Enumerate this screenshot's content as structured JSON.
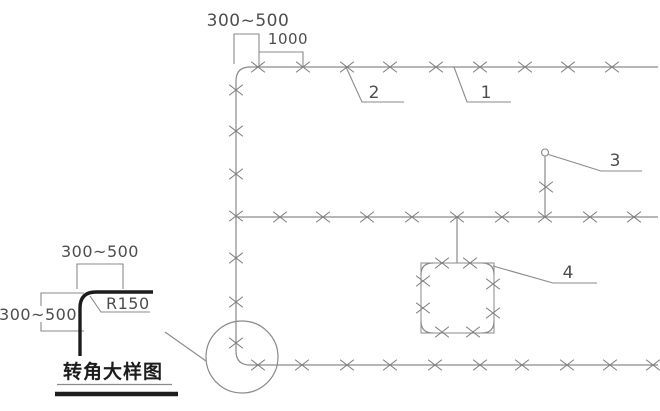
{
  "figure": {
    "width": 660,
    "height": 411,
    "colors": {
      "line": "#8a8a8a",
      "mark": "#7d7d7d",
      "text": "#4d4d4d",
      "ink": "#1c1c1c",
      "bg": "#ffffff"
    },
    "labels": {
      "dim_top_range": "300~500",
      "dim_top_spacing": "1000",
      "callout_1": "1",
      "callout_2": "2",
      "callout_3": "3",
      "callout_4": "4",
      "detail_dim_horizontal": "300~500",
      "detail_dim_vertical": "300~500",
      "detail_radius": "R150",
      "detail_title": "转角大样图"
    },
    "geometry": {
      "paths": [
        {
          "name": "main-cable-run",
          "d": "M 658,67 L 250,67 Q 236,67 236,81 L 236,351 Q 236,365 250,365 L 658,365",
          "color": "line",
          "w": 1.2
        },
        {
          "name": "middle-cable-run",
          "d": "M 236,217 L 658,217",
          "color": "line",
          "w": 1.2
        },
        {
          "name": "device-drop-line",
          "d": "M 457,217 L 457,263",
          "color": "line",
          "w": 1.2
        },
        {
          "name": "device-box-outline",
          "d": "M 421,263 L 494,263 L 494,333 L 421,333 Z",
          "color": "line",
          "w": 1.0
        },
        {
          "name": "device-box-corner-arcs",
          "d": "M 421,275 Q 421,263 433,263 M 482,263 Q 494,263 494,275 M 494,321 Q 494,333 482,333 M 433,333 Q 421,333 421,321",
          "color": "line",
          "w": 1.2
        },
        {
          "name": "branch-riser-stub",
          "d": "M 545,217 L 545,156.5",
          "color": "line",
          "w": 1.2
        },
        {
          "name": "leader-callout-1",
          "d": "M 454,67 L 467,102 L 511,102",
          "color": "line",
          "w": 1.1
        },
        {
          "name": "leader-callout-2",
          "d": "M 346,67 L 362,102 L 404,102",
          "color": "line",
          "w": 1.1
        },
        {
          "name": "leader-callout-3",
          "d": "M 548.5,154.5 L 601,171 L 642,171",
          "color": "line",
          "w": 1.1
        },
        {
          "name": "leader-callout-4",
          "d": "M 493,266 L 553,283 L 597,283",
          "color": "line",
          "w": 1.1
        },
        {
          "name": "dim-bracket-offset",
          "d": "M 234,64 L 234,34 L 259,34 L 259,66",
          "color": "line",
          "w": 1.1
        },
        {
          "name": "dim-bracket-spacing",
          "d": "M 259,52 L 303,52 L 303,66",
          "color": "line",
          "w": 1.1
        },
        {
          "name": "detail-dim-top-bracket",
          "d": "M 77,289 L 77,264 L 123,264 L 123,289",
          "color": "line",
          "w": 1.1
        },
        {
          "name": "detail-dim-left-upper",
          "d": "M 84,293 L 41,293 L 41,306",
          "color": "line",
          "w": 1.1
        },
        {
          "name": "detail-dim-left-lower",
          "d": "M 41,322 L 41,331 L 84,331",
          "color": "line",
          "w": 1.1
        },
        {
          "name": "radius-leader",
          "d": "M 90,296 L 101,312 L 150,312",
          "color": "line",
          "w": 1.1
        },
        {
          "name": "detail-reference-leader",
          "d": "M 165,332 L 206,361",
          "color": "line",
          "w": 1.1
        },
        {
          "name": "title-underline-thin",
          "d": "M 57,384.5 L 172,384.5",
          "color": "line",
          "w": 1.2
        },
        {
          "name": "detail-corner-elbow",
          "d": "M 153,292 L 96,292 Q 80,292 80,308 L 80,356",
          "color": "ink",
          "w": 3.4
        },
        {
          "name": "title-underline-thick",
          "d": "M 55,394 L 178,394",
          "color": "ink",
          "w": 4.4
        }
      ],
      "circles": [
        {
          "name": "callout-3-node",
          "cx": 545,
          "cy": 152.5,
          "r": 3.5,
          "fill": "#ffffff",
          "color": "line",
          "w": 1.1
        },
        {
          "name": "detail-reference-circle",
          "cx": 242,
          "cy": 357,
          "r": 36,
          "fill": "none",
          "color": "line",
          "w": 1.2
        }
      ],
      "xmarks": {
        "dx": 6.5,
        "dy": 5,
        "groups": [
          {
            "name": "top-run-marks",
            "points": [
              [
                258,
                67
              ],
              [
                303,
                67
              ],
              [
                347,
                67
              ],
              [
                390,
                67
              ],
              [
                436,
                67
              ],
              [
                480,
                67
              ],
              [
                525,
                67
              ],
              [
                568,
                67
              ],
              [
                612,
                67
              ]
            ]
          },
          {
            "name": "left-riser-marks",
            "points": [
              [
                236,
                90
              ],
              [
                236,
                131
              ],
              [
                236,
                174
              ],
              [
                236,
                216
              ],
              [
                236,
                258
              ],
              [
                236,
                302
              ],
              [
                236,
                343
              ]
            ]
          },
          {
            "name": "middle-run-marks",
            "points": [
              [
                280,
                217
              ],
              [
                323,
                217
              ],
              [
                367,
                217
              ],
              [
                412,
                217
              ],
              [
                457,
                217
              ],
              [
                502,
                217
              ],
              [
                545,
                217
              ],
              [
                590,
                217
              ],
              [
                634,
                217
              ]
            ]
          },
          {
            "name": "bottom-run-marks",
            "points": [
              [
                258,
                365
              ],
              [
                302,
                365
              ],
              [
                347,
                365
              ],
              [
                390,
                365
              ],
              [
                435,
                365
              ],
              [
                480,
                365
              ],
              [
                522,
                365
              ],
              [
                567,
                365
              ],
              [
                610,
                365
              ],
              [
                653,
                365
              ]
            ]
          },
          {
            "name": "branch-stub-mark",
            "points": [
              [
                546,
                187
              ]
            ]
          },
          {
            "name": "device-box-marks",
            "points": [
              [
                442,
                263
              ],
              [
                470,
                263
              ],
              [
                423,
                281
              ],
              [
                423,
                308
              ],
              [
                493,
                284
              ],
              [
                493,
                313
              ],
              [
                442,
                332
              ],
              [
                473,
                332
              ]
            ]
          }
        ]
      }
    }
  }
}
